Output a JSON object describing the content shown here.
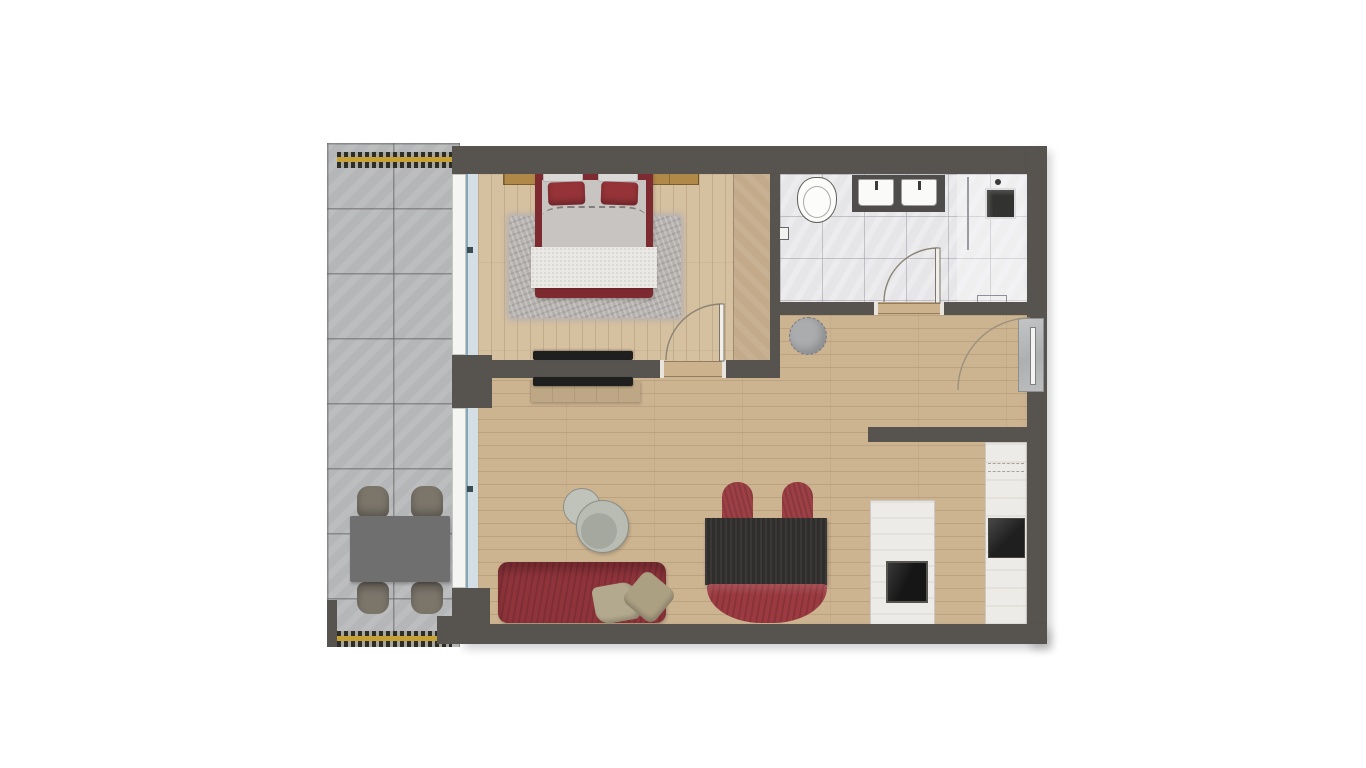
{
  "document": {
    "type": "floor-plan",
    "description": "Top-down rendered floor plan of a one-bedroom apartment: balcony on the left, bedroom and bathroom on top, hallway and open living room with kitchen below",
    "visible_text": []
  },
  "rooms": {
    "balcony": {
      "label": "balcony",
      "floor": "grey stone tiles",
      "items": [
        "outdoor dining table",
        "four outdoor chairs",
        "yellow-and-black railing top",
        "yellow-and-black railing bottom"
      ]
    },
    "bedroom": {
      "label": "bedroom",
      "floor": "light wood planks",
      "items": [
        "double bed with dark-red frame",
        "two red pillows",
        "grey duvet",
        "white quilted blanket",
        "shaggy grey rug",
        "golden wood headboard panel",
        "wardrobe strip",
        "wall-mounted TV",
        "door swinging inward"
      ]
    },
    "bathroom": {
      "label": "bathroom",
      "floor": "white marble tiles",
      "items": [
        "toilet",
        "toilet-paper holder",
        "dark double vanity with two white sinks",
        "walk-in shower with glass partition",
        "shower fixture",
        "bath mat",
        "door swinging inward"
      ]
    },
    "hallway": {
      "label": "hallway",
      "floor": "wood planks",
      "items": [
        "round grey pouf",
        "entrance door with swing arc"
      ]
    },
    "living_kitchen": {
      "label": "living room / kitchen",
      "floor": "wood planks",
      "items": [
        "red sofa with two beige pillows",
        "two round grey coffee tables",
        "black dining table",
        "two red chairs",
        "red curved bench",
        "TV lowboard with wall TV",
        "kitchen island with dark sink",
        "tall white cabinets with built-in oven",
        "kitchen stub wall"
      ]
    }
  },
  "colors": {
    "wall": "#575450",
    "wood_living": "#cdb491",
    "wood_bedroom": "#d5c0a0",
    "wood_wardrobe": "#c3aa8a",
    "balcony_tile": "#b5b6b8",
    "bath_tile": "#e6e6e8",
    "shower_tile": "#ededef",
    "bed_red": "#7d2b31",
    "pillow_red": "#953338",
    "sofa_red": "#8f343b",
    "chair_red": "#9c4046",
    "bench_red": "#9b3a40",
    "table_black": "#2f2e2c",
    "counter_white": "#edebe7",
    "appliance_black": "#1f1f1f",
    "railing_yellow": "#c7a133",
    "window_glass": "#d3dfe5",
    "headboard_wood": "#b08948",
    "rug_grey": "#b6b2af",
    "duvet_grey": "#c7c4c1",
    "blanket_white": "#eae8e4",
    "coffee_table_grey": "#b8bcb2",
    "balcony_furniture": "#6f6f6f",
    "balcony_chair": "#7b756a",
    "pouf_grey": "#abacae",
    "threshold_wood": "#ccb38e",
    "door_arc": "#8b8474",
    "tv_black": "#1f1f1f",
    "lowboard_tan": "#bda784"
  }
}
